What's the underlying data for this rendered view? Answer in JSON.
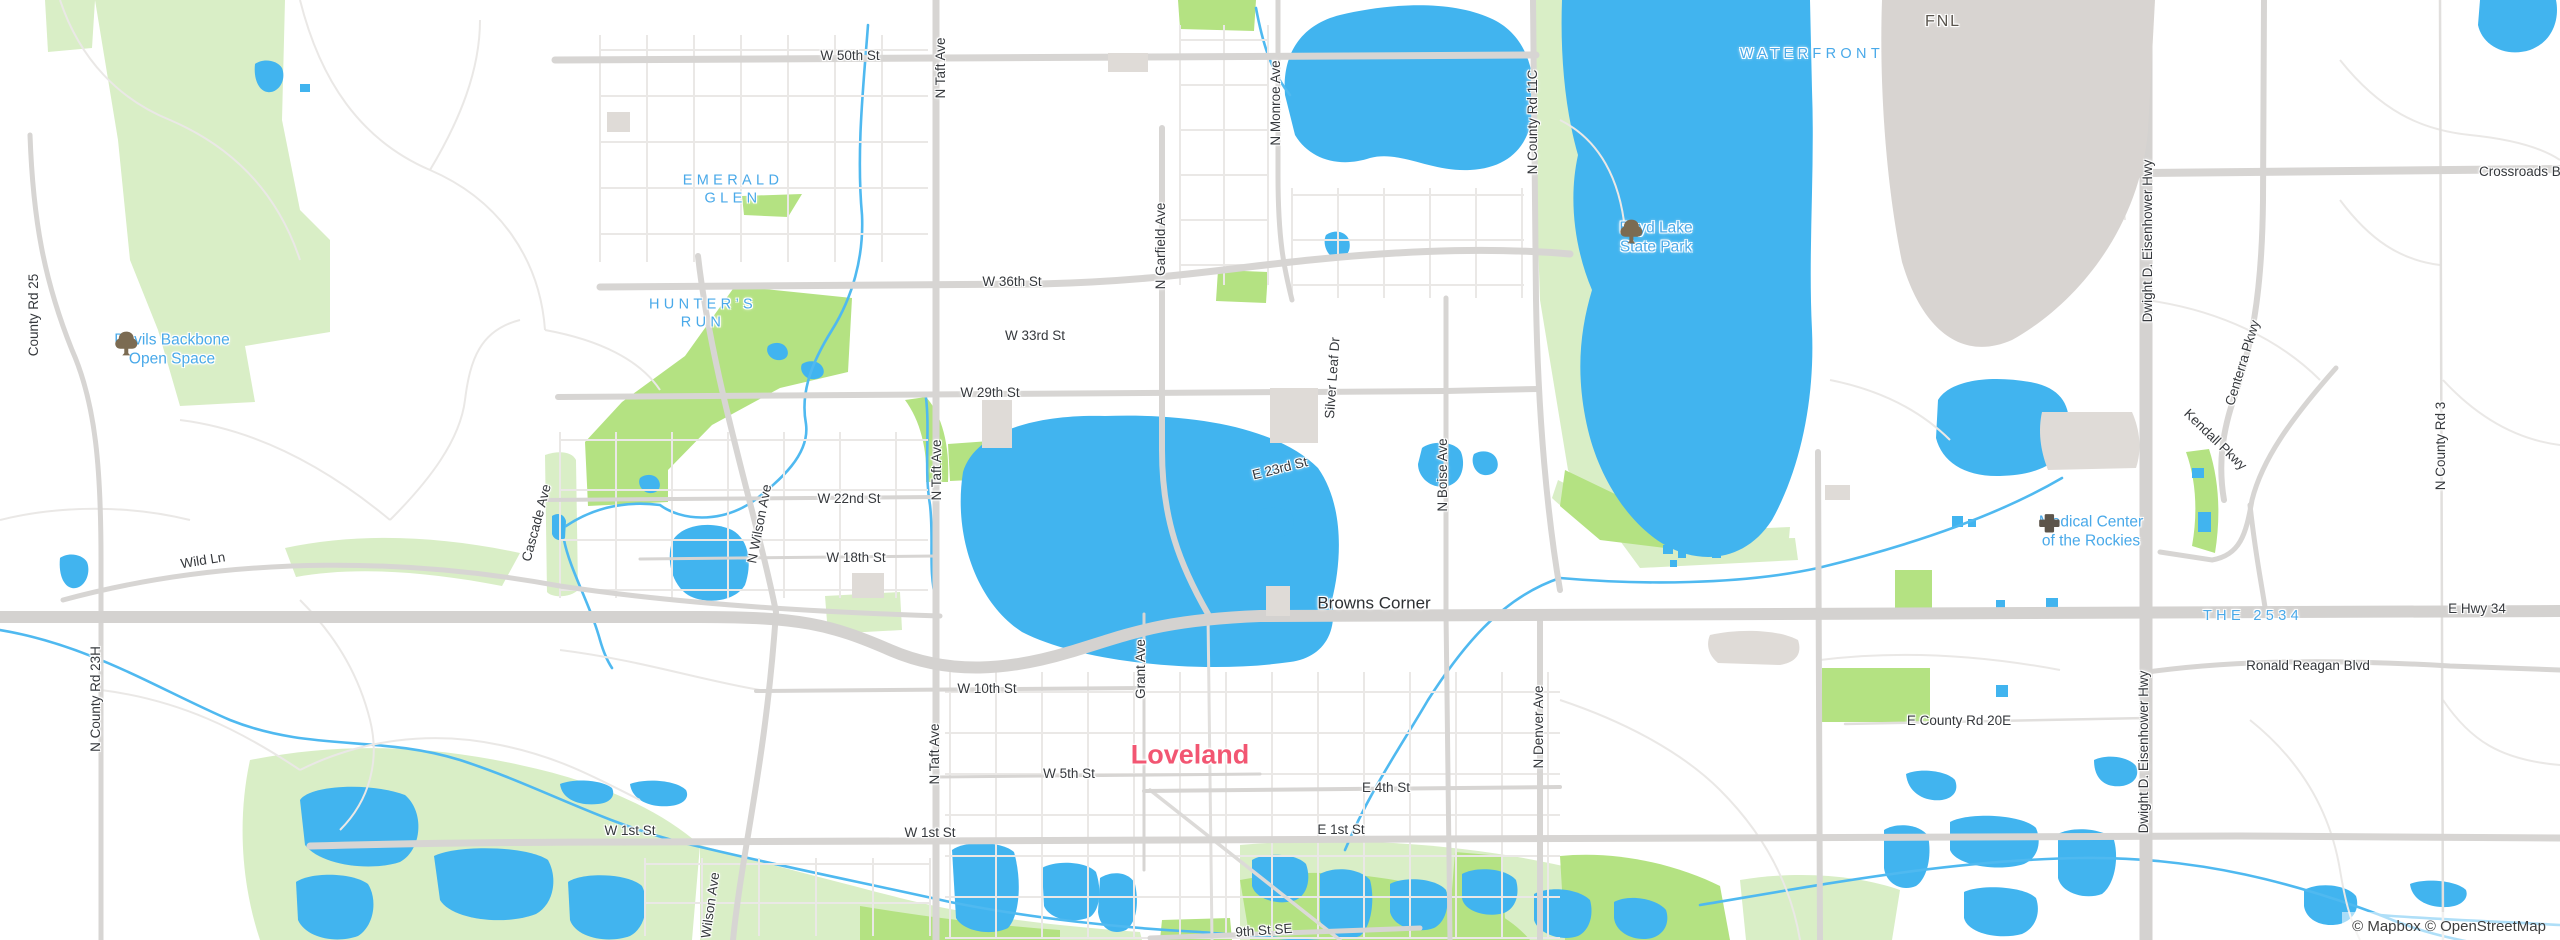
{
  "map": {
    "city_name": "Loveland",
    "attribution": {
      "text": "© Mapbox © OpenStreetMap"
    },
    "logo": {
      "text": "mapbox"
    },
    "colors": {
      "water": "#41b4ef",
      "river": "#4fb9f0",
      "park_pale": "#d9eec6",
      "park_bright": "#b4e282",
      "road_major": "#d7d5d3",
      "road_minor": "#eae8e6",
      "building": "#dfdbd7",
      "label_street": "#35383c",
      "label_area_blue": "#49a9e9",
      "label_city_pink": "#f25672",
      "label_airport": "#5a554e",
      "tree_icon_brown": "#7b6b52",
      "hospital_icon_brown": "#5d554b"
    },
    "labels": [
      {
        "id": "w-50th-st",
        "kind": "street",
        "text": "W 50th St",
        "x": 850,
        "y": 56,
        "rot": 0
      },
      {
        "id": "n-taft-ave-north",
        "kind": "street",
        "text": "N Taft Ave",
        "x": 941,
        "y": 68,
        "rot": -90
      },
      {
        "id": "n-monroe-ave",
        "kind": "street",
        "text": "N Monroe Ave",
        "x": 1276,
        "y": 103,
        "rot": -90
      },
      {
        "id": "n-county-rd-11c",
        "kind": "street",
        "text": "N County Rd 11C",
        "x": 1533,
        "y": 122,
        "rot": -90
      },
      {
        "id": "w-36th-st",
        "kind": "street",
        "text": "W 36th St",
        "x": 1012,
        "y": 282,
        "rot": 0
      },
      {
        "id": "w-33rd-st",
        "kind": "street",
        "text": "W 33rd St",
        "x": 1035,
        "y": 336,
        "rot": 0
      },
      {
        "id": "w-29th-st",
        "kind": "street",
        "text": "W 29th St",
        "x": 990,
        "y": 393,
        "rot": 0
      },
      {
        "id": "n-garfield-ave",
        "kind": "street",
        "text": "N Garfield Ave",
        "x": 1161,
        "y": 246,
        "rot": -90
      },
      {
        "id": "silver-leaf-dr",
        "kind": "street",
        "text": "Silver Leaf Dr",
        "x": 1333,
        "y": 378,
        "rot": -86
      },
      {
        "id": "e-23rd-st",
        "kind": "street",
        "text": "E 23rd St",
        "x": 1280,
        "y": 469,
        "rot": -14
      },
      {
        "id": "n-boise-ave",
        "kind": "street",
        "text": "N Boise Ave",
        "x": 1443,
        "y": 475,
        "rot": -90
      },
      {
        "id": "w-22nd-st",
        "kind": "street",
        "text": "W 22nd St",
        "x": 849,
        "y": 499,
        "rot": 0
      },
      {
        "id": "n-taft-ave-mid",
        "kind": "street",
        "text": "N Taft Ave",
        "x": 937,
        "y": 470,
        "rot": -90
      },
      {
        "id": "w-18th-st",
        "kind": "street",
        "text": "W 18th St",
        "x": 856,
        "y": 558,
        "rot": 0
      },
      {
        "id": "cascade-ave",
        "kind": "street",
        "text": "Cascade Ave",
        "x": 537,
        "y": 523,
        "rot": -75
      },
      {
        "id": "n-wilson-ave",
        "kind": "street",
        "text": "N Wilson Ave",
        "x": 760,
        "y": 524,
        "rot": -79
      },
      {
        "id": "wild-ln",
        "kind": "street",
        "text": "Wild Ln",
        "x": 203,
        "y": 561,
        "rot": -9
      },
      {
        "id": "county-rd-25",
        "kind": "street",
        "text": "County Rd 25",
        "x": 34,
        "y": 315,
        "rot": -90
      },
      {
        "id": "n-county-rd-23h",
        "kind": "street",
        "text": "N County Rd 23H",
        "x": 96,
        "y": 699,
        "rot": -90
      },
      {
        "id": "eisenhower-hwy-north",
        "kind": "street",
        "text": "Dwight D. Eisenhower Hwy",
        "x": 2148,
        "y": 241,
        "rot": -90
      },
      {
        "id": "eisenhower-hwy-south",
        "kind": "street",
        "text": "Dwight D. Eisenhower Hwy",
        "x": 2144,
        "y": 752,
        "rot": -90
      },
      {
        "id": "centerra-pkwy",
        "kind": "street",
        "text": "Centerra Pkwy",
        "x": 2243,
        "y": 363,
        "rot": -73
      },
      {
        "id": "kendall-pkwy",
        "kind": "street",
        "text": "Kendall Pkwy",
        "x": 2215,
        "y": 440,
        "rot": 44
      },
      {
        "id": "n-county-rd-3",
        "kind": "street",
        "text": "N County Rd 3",
        "x": 2441,
        "y": 446,
        "rot": -90
      },
      {
        "id": "e-hwy-34",
        "kind": "street",
        "text": "E Hwy 34",
        "x": 2477,
        "y": 609,
        "rot": 0
      },
      {
        "id": "ronald-reagan-blvd",
        "kind": "street",
        "text": "Ronald Reagan Blvd",
        "x": 2308,
        "y": 666,
        "rot": 0
      },
      {
        "id": "e-county-rd-20e",
        "kind": "street",
        "text": "E County Rd 20E",
        "x": 1959,
        "y": 721,
        "rot": 0
      },
      {
        "id": "w-10th-st",
        "kind": "street",
        "text": "W 10th St",
        "x": 987,
        "y": 689,
        "rot": 0
      },
      {
        "id": "grant-ave",
        "kind": "street",
        "text": "Grant Ave",
        "x": 1141,
        "y": 669,
        "rot": -90
      },
      {
        "id": "w-5th-st",
        "kind": "street",
        "text": "W 5th St",
        "x": 1069,
        "y": 774,
        "rot": 0
      },
      {
        "id": "e-4th-st",
        "kind": "street",
        "text": "E 4th St",
        "x": 1386,
        "y": 788,
        "rot": 0
      },
      {
        "id": "n-denver-ave",
        "kind": "street",
        "text": "N Denver Ave",
        "x": 1539,
        "y": 727,
        "rot": -90
      },
      {
        "id": "w-1st-st-west",
        "kind": "street",
        "text": "W 1st St",
        "x": 630,
        "y": 831,
        "rot": 0
      },
      {
        "id": "w-1st-st",
        "kind": "street",
        "text": "W 1st St",
        "x": 930,
        "y": 833,
        "rot": 0
      },
      {
        "id": "e-1st-st",
        "kind": "street",
        "text": "E 1st St",
        "x": 1341,
        "y": 830,
        "rot": 0
      },
      {
        "id": "n-taft-ave-south",
        "kind": "street",
        "text": "N Taft Ave",
        "x": 935,
        "y": 754,
        "rot": -90
      },
      {
        "id": "n-wilson-ave-south",
        "kind": "street",
        "text": "N Wilson Ave",
        "x": 710,
        "y": 912,
        "rot": -82
      },
      {
        "id": "9th-st-se",
        "kind": "street",
        "text": "9th St SE",
        "x": 1264,
        "y": 931,
        "rot": -4
      },
      {
        "id": "crossroads-blvd",
        "kind": "street",
        "text": "Crossroads Blvd",
        "x": 2479,
        "y": 172,
        "rot": 0,
        "anchor": "left"
      },
      {
        "id": "emerald-glen",
        "kind": "hood",
        "text": "EMERALD\nGLEN",
        "x": 733,
        "y": 190,
        "rot": 0
      },
      {
        "id": "hunters-run",
        "kind": "hood",
        "text": "HUNTER’S\nRUN",
        "x": 703,
        "y": 314,
        "rot": 0
      },
      {
        "id": "waterfront",
        "kind": "hood",
        "text": "WATERFRONT",
        "x": 1812,
        "y": 55,
        "rot": 0
      },
      {
        "id": "the-2534",
        "kind": "hood",
        "text": "THE 2534",
        "x": 2253,
        "y": 617,
        "rot": 0
      },
      {
        "id": "devils-backbone-open-space",
        "kind": "park",
        "icon": "tree",
        "text": "Devils Backbone\nOpen Space",
        "x": 172,
        "y": 350,
        "rot": 0
      },
      {
        "id": "boyd-lake-state-park",
        "kind": "park",
        "icon": "tree",
        "text": "Boyd Lake\nState Park",
        "x": 1656,
        "y": 238,
        "rot": 0
      },
      {
        "id": "medical-center-of-the-rockies",
        "kind": "poi",
        "icon": "cross",
        "text": "Medical Center\nof the Rockies",
        "x": 2091,
        "y": 532,
        "rot": 0
      },
      {
        "id": "loveland",
        "kind": "city",
        "text": "Loveland",
        "x": 1190,
        "y": 755,
        "rot": 0
      },
      {
        "id": "browns-corner",
        "kind": "town",
        "text": "Browns Corner",
        "x": 1374,
        "y": 604,
        "rot": 0
      },
      {
        "id": "fnl",
        "kind": "airport",
        "text": "FNL",
        "x": 1943,
        "y": 22,
        "rot": 0
      }
    ]
  }
}
